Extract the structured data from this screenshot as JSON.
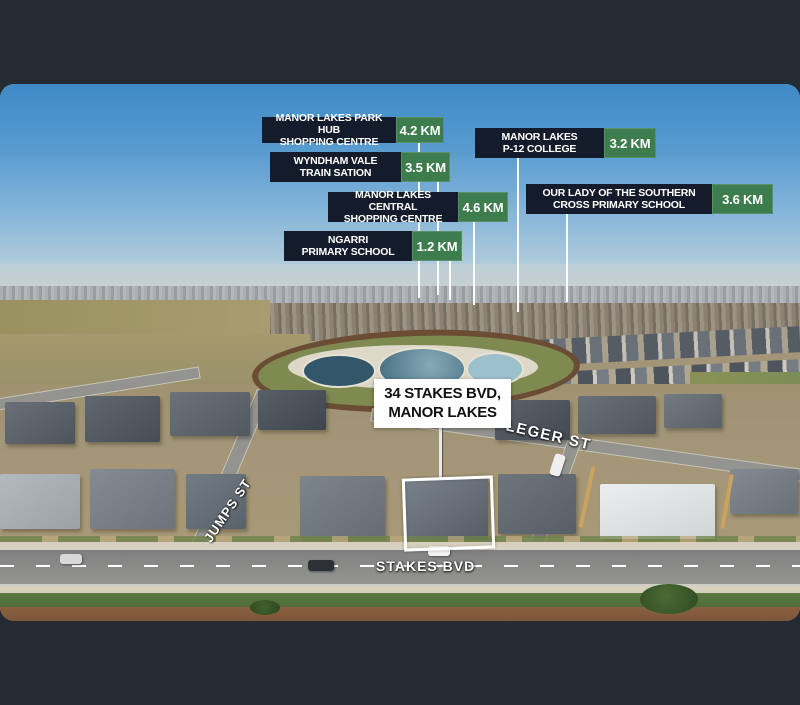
{
  "frame": {
    "bar_color": "#242b33"
  },
  "amenity_labels": [
    {
      "line1": "MANOR LAKES PARK HUB",
      "line2": "SHOPPING CENTRE",
      "distance": "4.2 KM"
    },
    {
      "line1": "WYNDHAM VALE",
      "line2": "TRAIN SATION",
      "distance": "3.5 KM"
    },
    {
      "line1": "MANOR LAKES",
      "line2": "P-12 COLLEGE",
      "distance": "3.2 KM"
    },
    {
      "line1": "MANOR LAKES CENTRAL",
      "line2": "SHOPPING CENTRE",
      "distance": "4.6 KM"
    },
    {
      "line1": "OUR LADY OF THE SOUTHERN",
      "line2": "CROSS PRIMARY SCHOOL",
      "distance": "3.6 KM"
    },
    {
      "line1": "NGARRI",
      "line2": "PRIMARY SCHOOL",
      "distance": "1.2 KM"
    }
  ],
  "property_label": {
    "line1": "34 STAKES BVD,",
    "line2": "MANOR LAKES"
  },
  "street_labels": {
    "jumps": "JUMPS ST",
    "leger": "LEGER ST",
    "stakes": "STAKES BVD"
  },
  "colors": {
    "label_dark_box": "#141c2b",
    "label_green_box": "#3d7d4d",
    "label_text": "#ffffff",
    "property_box": "#ffffff",
    "property_text": "#111111",
    "leader_line": "#ffffff"
  }
}
